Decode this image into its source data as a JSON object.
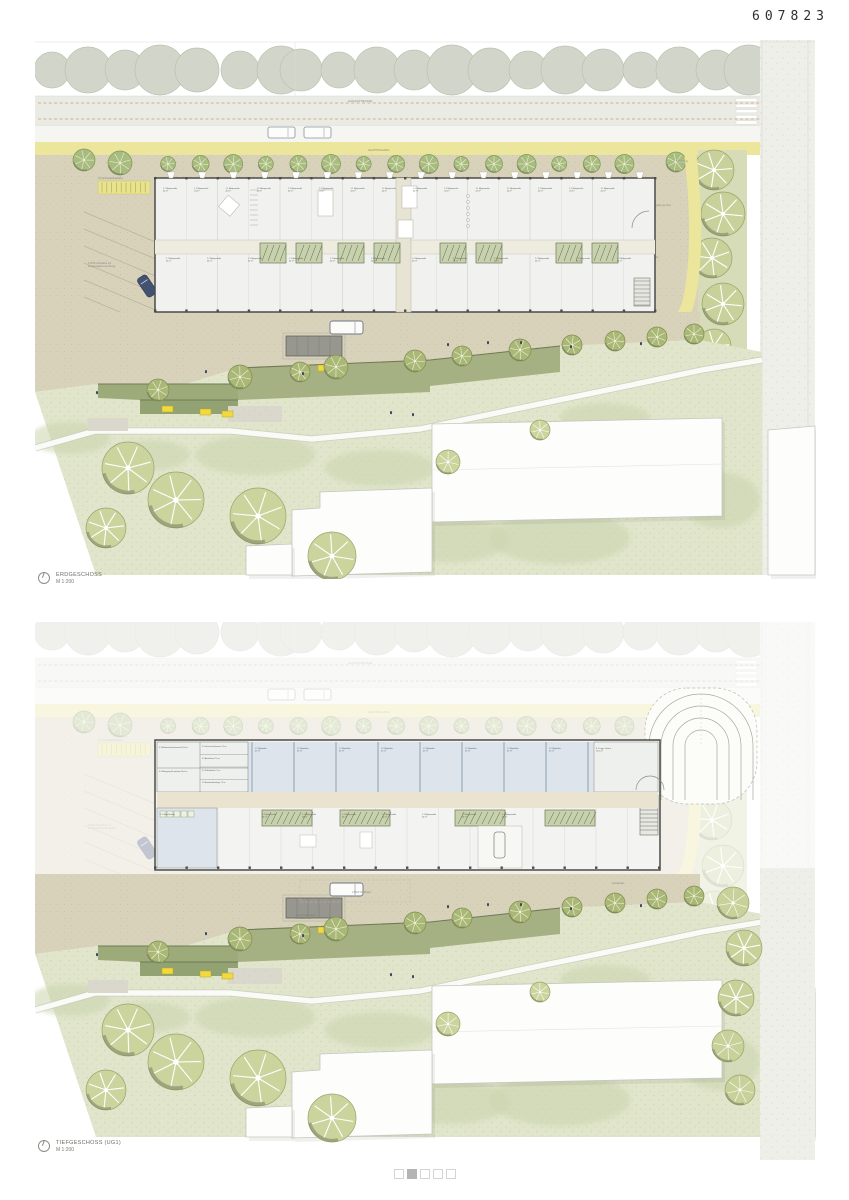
{
  "sheet": {
    "number": "607823",
    "pager": {
      "count": 5,
      "active": 2
    }
  },
  "plan_top": {
    "caption": "ERDGESCHOSS",
    "scale": "M 1:200",
    "street_label": "HANSASTRASSE",
    "main_entrance_label": "HAUPTZUGANG",
    "bike_label": "26 Fahrradabstellplätze",
    "parking_label_1": "5 PKW-Stellplätze mit",
    "parking_label_2": "E-Ladestationsvorrüstung",
    "delivery_label": "Anlieferung",
    "exit_label": "Ausgang aus UG1",
    "visitor_parking_label": "2 PKW Stellplätze",
    "unit_label": "1.1 Mietparzelle",
    "unit_area": "44 m²"
  },
  "plan_bottom": {
    "caption": "TIEFGESCHOSS (UG1)",
    "scale": "M 1:200",
    "cellar_label": "1.2 Mietkeller",
    "cellar_area": "47 m²",
    "storage_label": "6.1 Lager Gastro",
    "storage_area": "19,5 m²",
    "tech_rooms": [
      "5.3 Medienanschlussraum 50,0 m²",
      "5.4 Übergang Fernwärme 50,0 m²",
      "5.1 Hausanschlussraum 7,5 m²",
      "5.2 Abstellraum 7,5 m²",
      "5.5 Kellerabteile 7,5 m²",
      "5.6 Brandmeldeanlage 7,5 m²"
    ],
    "unit_label": "1.1 Mietparzelle",
    "unit_area": "44 m²",
    "laundry_label": "2.1 Waschküche",
    "parking_label": "2 PKW Stellplätze",
    "play_label": "Spielgeräte",
    "garden_label_1": "Lauschige Plätze",
    "garden_label_2": "im Blätterhain"
  }
}
